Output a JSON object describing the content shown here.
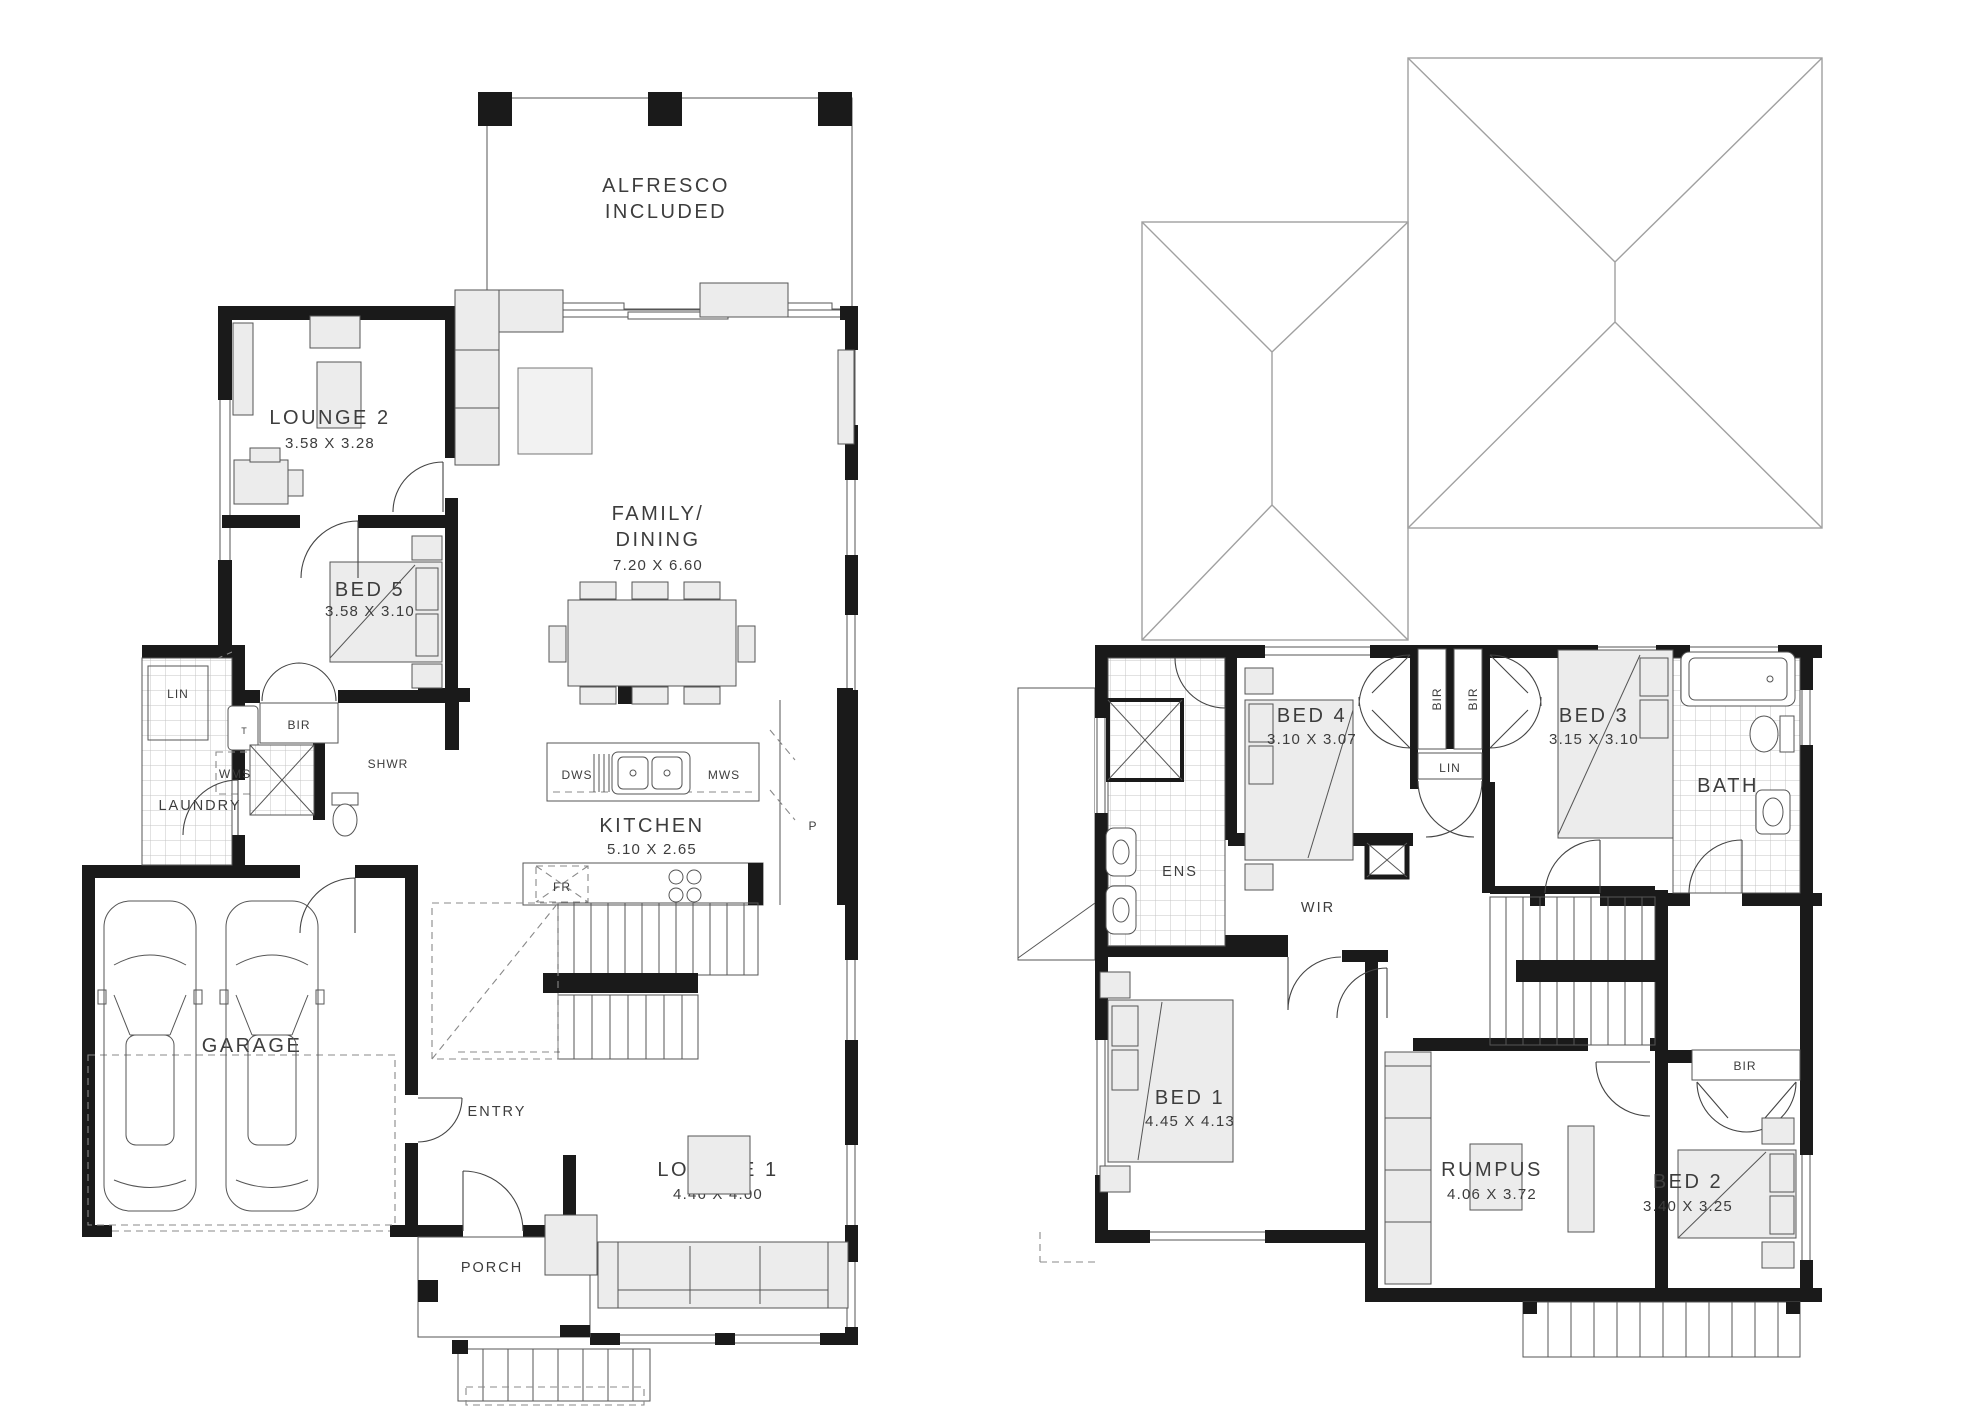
{
  "meta": {
    "drawing_type": "two-storey residential floor plan",
    "background_color": "#ffffff",
    "wall_color": "#1a1a1a",
    "furniture_fill": "#ececec",
    "label_color": "#3d3d3d"
  },
  "ground_floor": {
    "alfresco": {
      "line1": "ALFRESCO",
      "line2": "INCLUDED"
    },
    "lounge2": {
      "label": "LOUNGE 2",
      "dims": "3.58 X 3.28"
    },
    "family_dining": {
      "line1": "FAMILY/",
      "line2": "DINING",
      "dims": "7.20 X 6.60"
    },
    "bed5": {
      "label": "BED 5",
      "dims": "3.58 X 3.10"
    },
    "lin": {
      "label": "LIN"
    },
    "bir": {
      "label": "BIR"
    },
    "shwr": {
      "label": "SHWR"
    },
    "wms": {
      "label": "WMS"
    },
    "trough": {
      "label": "T"
    },
    "laundry": {
      "label": "LAUNDRY"
    },
    "kitchen": {
      "label": "KITCHEN",
      "dims": "5.10 X 2.65"
    },
    "dws": {
      "label": "DWS"
    },
    "mws": {
      "label": "MWS"
    },
    "fridge": {
      "label": "FR"
    },
    "pantry": {
      "label": "P"
    },
    "garage": {
      "label": "GARAGE"
    },
    "entry": {
      "label": "ENTRY"
    },
    "lounge1": {
      "label": "LOUNGE 1",
      "dims": "4.46 X 4.00"
    },
    "porch": {
      "label": "PORCH"
    }
  },
  "first_floor": {
    "ens": {
      "label": "ENS"
    },
    "bed4": {
      "label": "BED 4",
      "dims": "3.10 X 3.07"
    },
    "bir_left": {
      "label": "BIR"
    },
    "bir_right": {
      "label": "BIR"
    },
    "lin": {
      "label": "LIN"
    },
    "bed3": {
      "label": "BED 3",
      "dims": "3.15 X 3.10"
    },
    "bath": {
      "label": "BATH"
    },
    "wir": {
      "label": "WIR"
    },
    "bed1": {
      "label": "BED 1",
      "dims": "4.45 X 4.13"
    },
    "rumpus": {
      "label": "RUMPUS",
      "dims": "4.06 X 3.72"
    },
    "bed2": {
      "label": "BED 2",
      "dims": "3.40 X 3.25"
    },
    "bir_bed2": {
      "label": "BIR"
    }
  }
}
